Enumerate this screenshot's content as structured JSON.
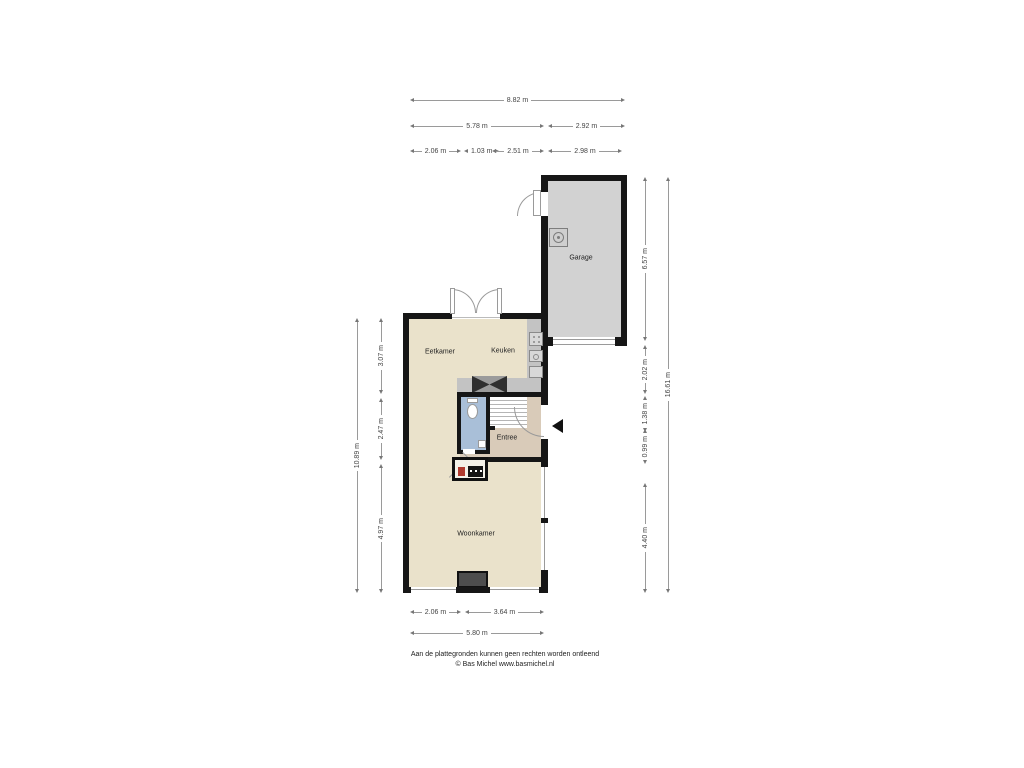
{
  "plan": {
    "rooms": {
      "garage": "Garage",
      "eetkamer": "Eetkamer",
      "keuken": "Keuken",
      "entree": "Entree",
      "woonkamer": "Woonkamer"
    },
    "dims": {
      "t_total": "8.82 m",
      "t_house": "5.78 m",
      "t_garage": "2.92 m",
      "t_a": "2.06 m",
      "t_b": "1.03 m",
      "t_c": "2.51 m",
      "t_d": "2.98 m",
      "l_total": "10.89 m",
      "l_a": "3.07 m",
      "l_b": "2.47 m",
      "l_c": "4.97 m",
      "r_total": "16.61 m",
      "r_a": "6.57 m",
      "r_b": "2.02 m",
      "r_c": "1.38 m",
      "r_d": "0.99 m",
      "r_e": "4.40 m",
      "b_a": "2.06 m",
      "b_b": "3.64 m",
      "b_total": "5.80 m"
    },
    "footer": {
      "line1": "Aan de plattegronden kunnen geen rechten worden ontleend",
      "line2": "© Bas Michel www.basmichel.nl"
    },
    "colors": {
      "floor": "#EAE2CB",
      "entree_floor": "#D9CBB9",
      "toilet_floor": "#A9BFD8",
      "garage_floor": "#D2D2D2",
      "counter": "#C3C3C3",
      "wall": "#161616"
    }
  }
}
